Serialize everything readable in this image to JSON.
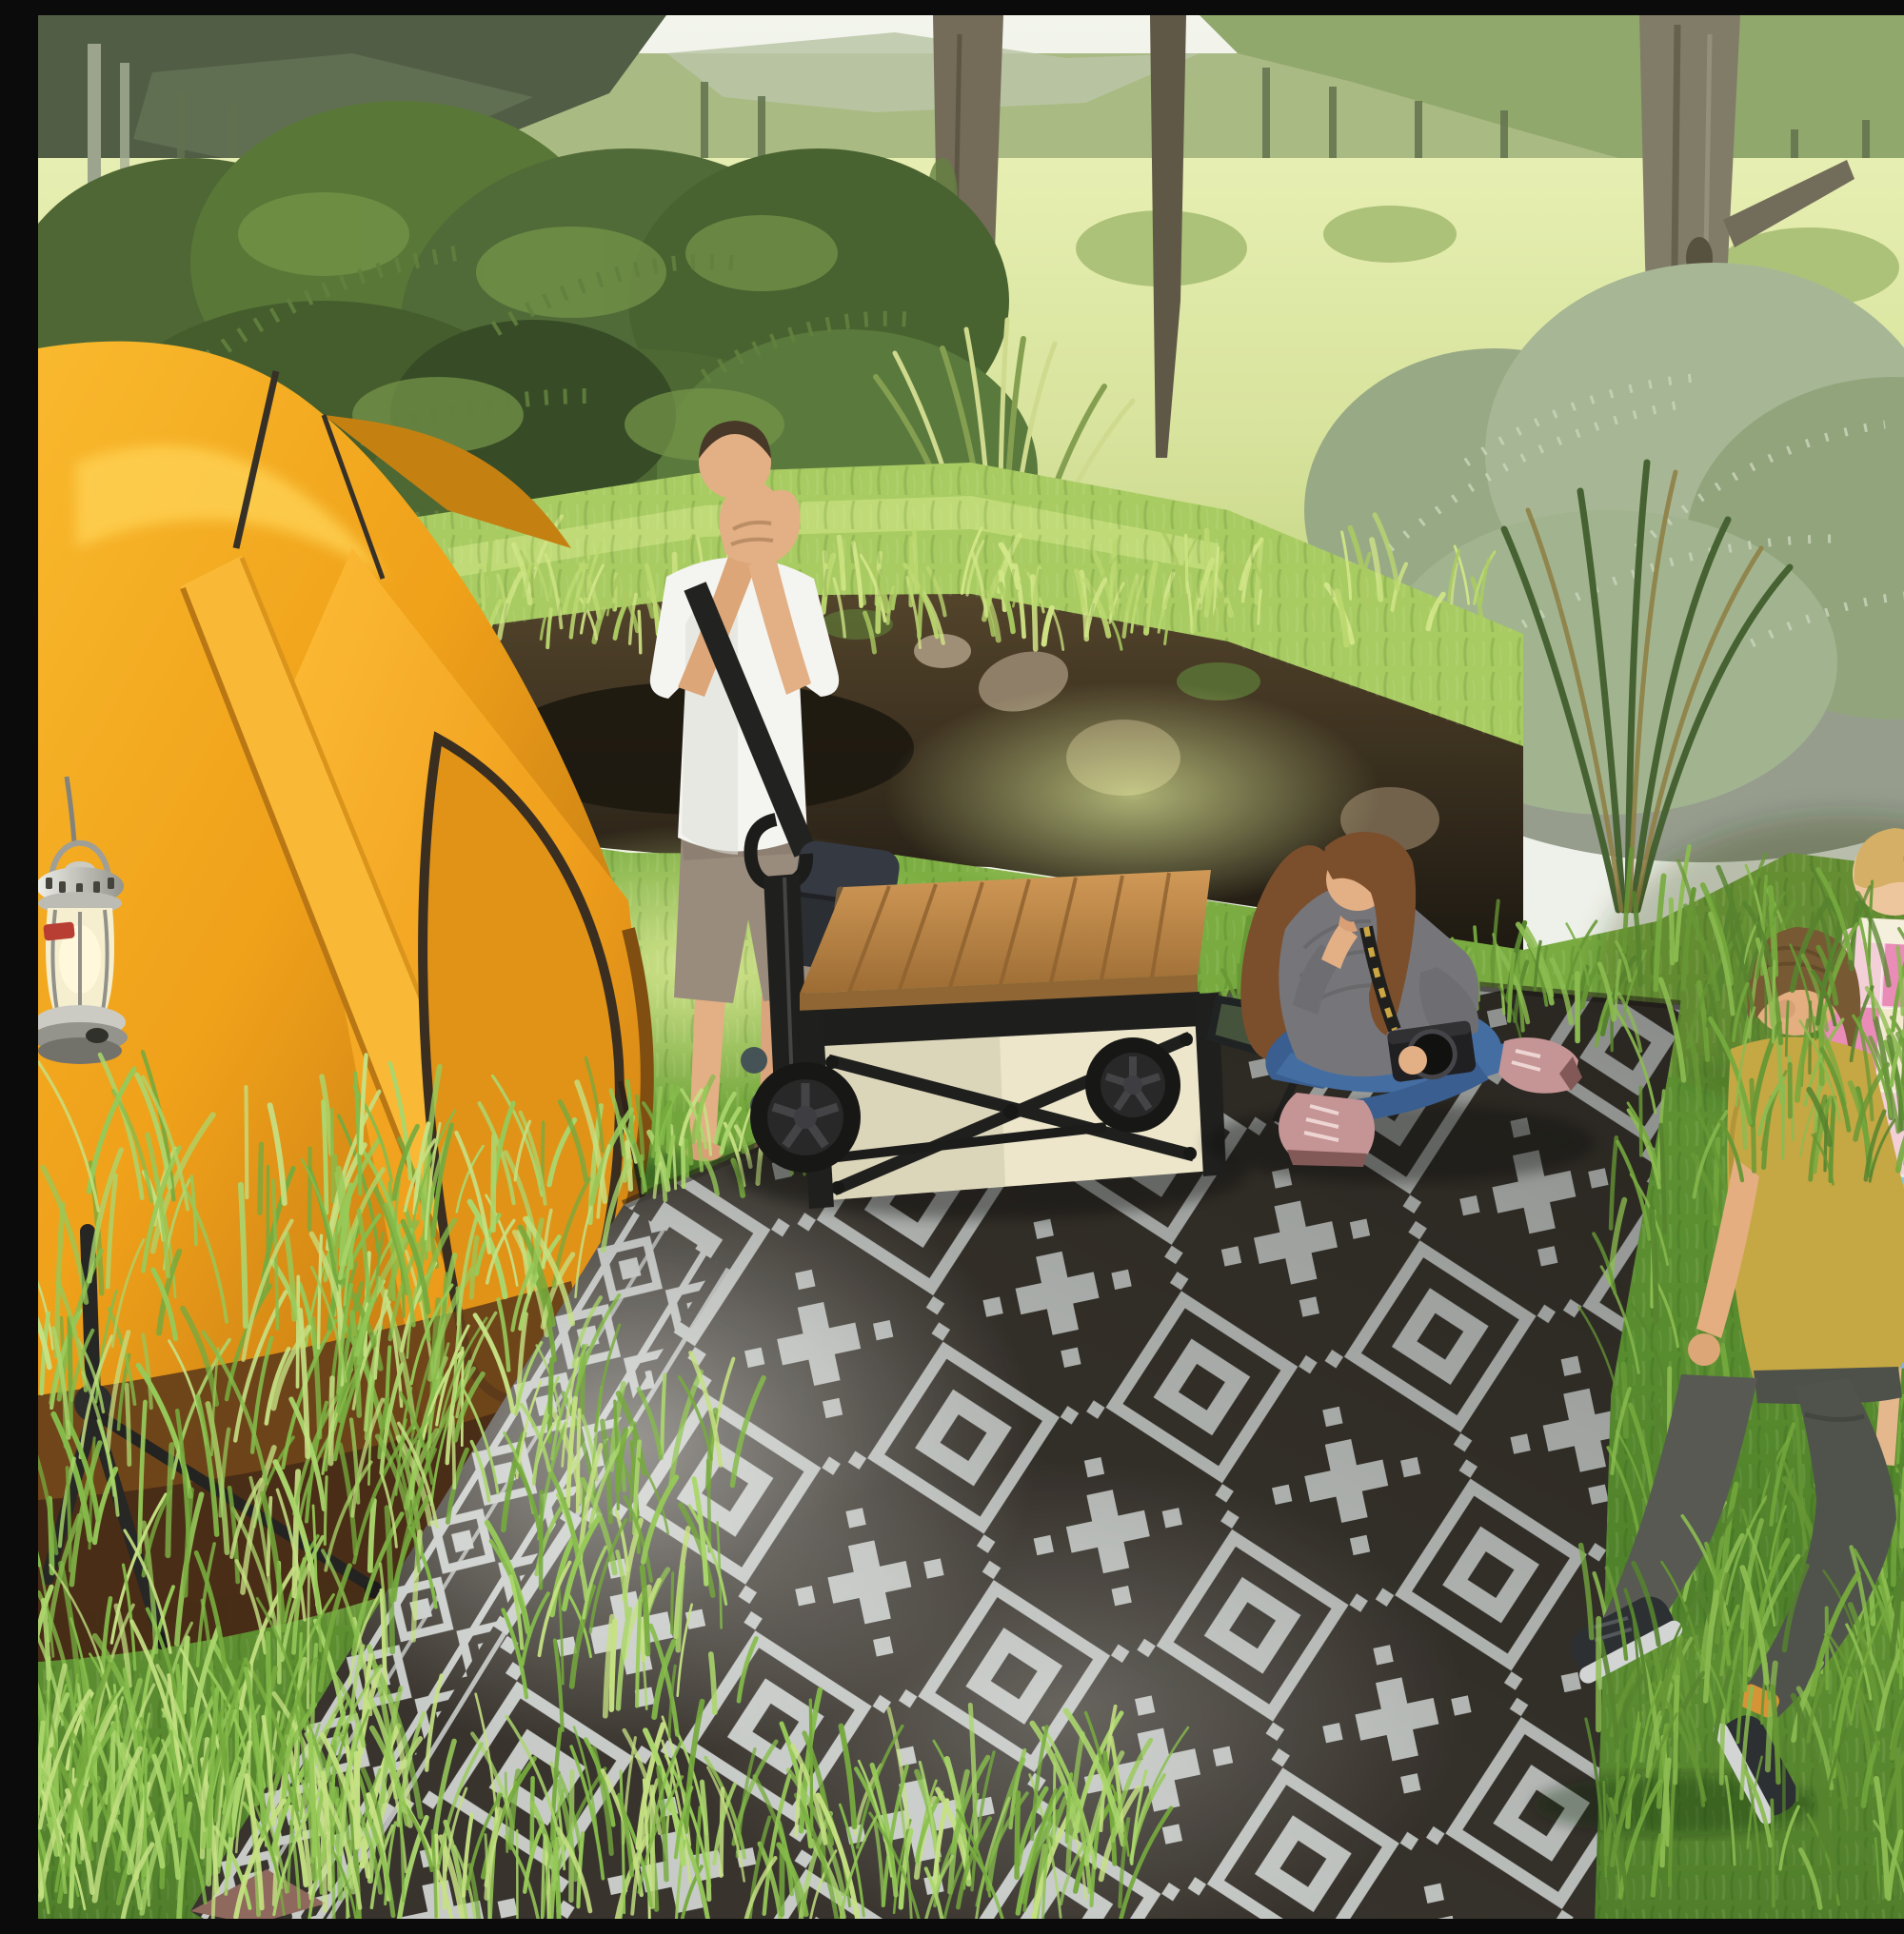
{
  "scene": {
    "type": "photographic product lifestyle render",
    "setting": "sunny forest meadow campsite",
    "description": "Campsite scene: orange dome tent with hanging silver lantern on the left, a laughing man in a white t-shirt and khaki shorts standing on grass, a collapsible camping wagon with a wooden table top and green side tray, a woman in a gray off-shoulder sweater sitting cross-legged with a camera on a large black-and-gray geometric outdoor rug, and two children (a boy in a mustard t-shirt and a girl with a blonde braid in a pastel plaid top) walking on the grass at the right. Dense green shrubs, tree trunks and a sunlit meadow fill the background.",
    "people_count": 4
  },
  "palette": {
    "sky": "#eef1ea",
    "mountain_dark": "#49553e",
    "forest_band": "#9db073",
    "hill_right": "#8ca468",
    "meadow_light": "#e3ecab",
    "meadow": "#cfdd90",
    "shrub_dark": "#3f5a28",
    "shrub": "#51702f",
    "shrub_light": "#6d8f42",
    "sage": "#a3b492",
    "sage_dark": "#8da078",
    "trunk": "#7b7563",
    "trunk_dark": "#57503f",
    "bank_grass": "#a4c95c",
    "soil": "#3a2d1b",
    "soil_dark": "#15100a",
    "rock": "#8a7963",
    "lawn": "#69a233",
    "lawn_dark": "#4a7a24",
    "lawn_light": "#8fc24b",
    "sun_patch": "#d9eb8e",
    "tent_amber": "#f2a112",
    "tent_light": "#ffd04e",
    "tent_deep": "#b36a07",
    "tent_shadow": "#5a3210",
    "tent_seam": "#7a4a08",
    "lantern_silver": "#d8d8d4",
    "lantern_glass": "#f5efcf",
    "lantern_red": "#b5342c",
    "frame_black": "#141414",
    "wagon_cream": "#ece5cb",
    "wood": "#bd8440",
    "wood_dark": "#96642c",
    "tray_green": "#3d4a34",
    "rug_dark": "#2e2924",
    "rug_light": "#c4c8c7",
    "rug_under": "#8a6158",
    "skin": "#e2ab80",
    "skin_shade": "#c08b60",
    "man_shirt": "#f4f4f2",
    "man_shorts": "#958678",
    "man_hair": "#3f2e1f",
    "bag_black": "#20232b",
    "woman_sweater": "#6f6f75",
    "jeans": "#3a67a0",
    "jeans_dark": "#2f568c",
    "boots_pink": "#c28f92",
    "woman_hair": "#744523",
    "boy_shirt": "#c2a33c",
    "boy_pants": "#4e514b",
    "boy_hair": "#70522c",
    "sneaker": "#22252a",
    "sole": "#d0d3d4",
    "sock_orange": "#d48f2e",
    "girl_hair": "#d2ab5f",
    "plaid_pink": "#e886b6",
    "plaid_rose": "#f3cdd9",
    "plaid_blue": "#84c2d9",
    "plaid_cream": "#f4e8cf",
    "skirt_blue": "#84a9d8"
  },
  "objects": {
    "background": {
      "label": "sunlit meadow with distant forested mountains, tree trunks and shrubs"
    },
    "tent": {
      "label": "orange dome camping tent with dark door outline and poles"
    },
    "lantern": {
      "label": "silver camping lantern with cream glass globe and red badge hanging by the tent"
    },
    "tripod": {
      "label": "black tripod lantern stand in the grass"
    },
    "man": {
      "label": "laughing man in white t-shirt, khaki shorts and black crossbody bag standing barefoot on the grass"
    },
    "wagon": {
      "label": "collapsible camping wagon with cream fabric, black frame, wooden table top and dark green side tray"
    },
    "woman": {
      "label": "woman in gray off-shoulder sweater and jeans sitting cross-legged on the rug holding a camera"
    },
    "boy": {
      "label": "boy in mustard t-shirt and dark pants walking through the grass"
    },
    "girl": {
      "label": "girl with blonde braid in pastel plaid top and blue skirt"
    },
    "rug": {
      "label": "large black and gray aztec-pattern reversible outdoor rug laid diagonally on the grass"
    }
  }
}
